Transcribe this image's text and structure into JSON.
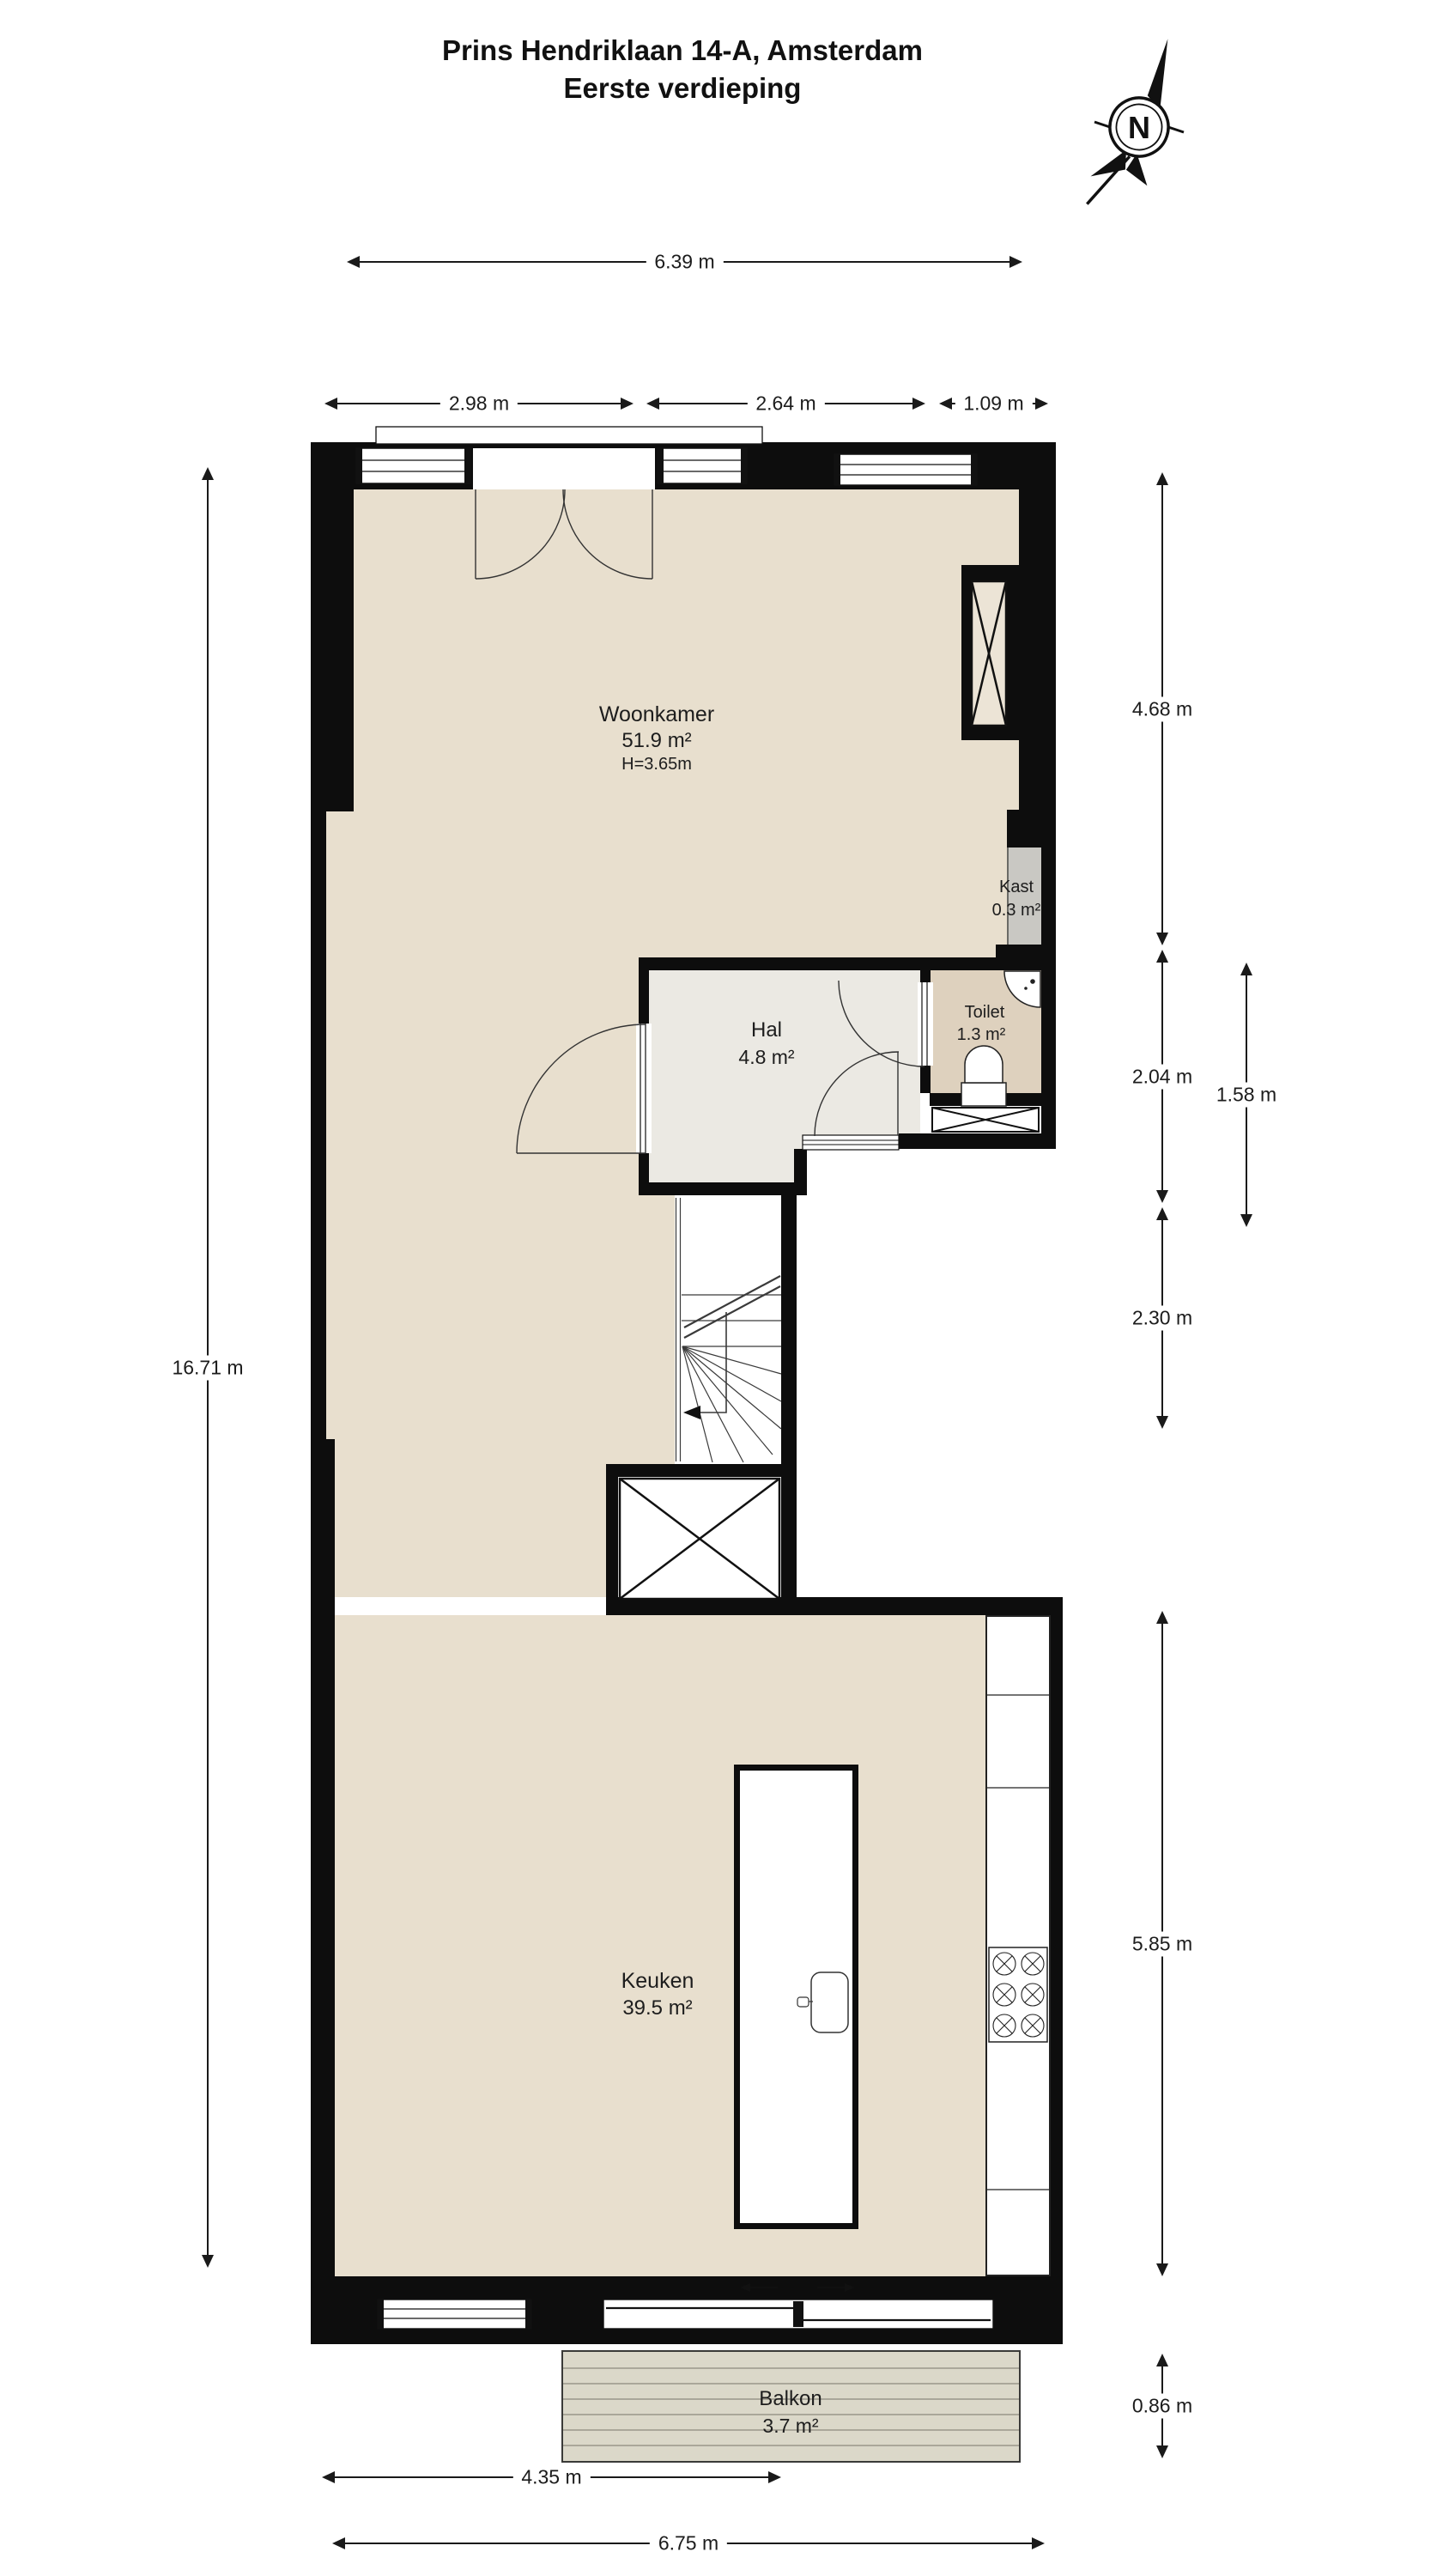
{
  "title": {
    "line1": "Prins Hendriklaan 14-A, Amsterdam",
    "line2": "Eerste verdieping"
  },
  "compass": {
    "label": "N"
  },
  "rooms": {
    "woonkamer": {
      "name": "Woonkamer",
      "area": "51.9 m²",
      "ceiling": "H=3.65m"
    },
    "hal": {
      "name": "Hal",
      "area": "4.8 m²"
    },
    "toilet": {
      "name": "Toilet",
      "area": "1.3 m²"
    },
    "kast": {
      "name": "Kast",
      "area": "0.3 m²"
    },
    "keuken": {
      "name": "Keuken",
      "area": "39.5 m²"
    },
    "balkon": {
      "name": "Balkon",
      "area": "3.7 m²"
    }
  },
  "dimensions": {
    "top_total": "6.39 m",
    "top_left": "2.98 m",
    "top_mid": "2.64 m",
    "top_right": "1.09 m",
    "left_total": "16.71 m",
    "right_upper": "4.68 m",
    "right_hal": "2.04 m",
    "right_toilet": "1.58 m",
    "right_stairs": "2.30 m",
    "right_kitchen": "5.85 m",
    "right_balcony": "0.86 m",
    "bottom_inner": "4.35 m",
    "bottom_total": "6.75 m"
  },
  "colors": {
    "wall": "#0d0d0d",
    "floor_main": "#e8dfce",
    "floor_hal": "#ebe9e3",
    "floor_toilet": "#ded1be",
    "kast_fill": "#c9c8c3",
    "balcony_fill": "#dbd8c9"
  }
}
